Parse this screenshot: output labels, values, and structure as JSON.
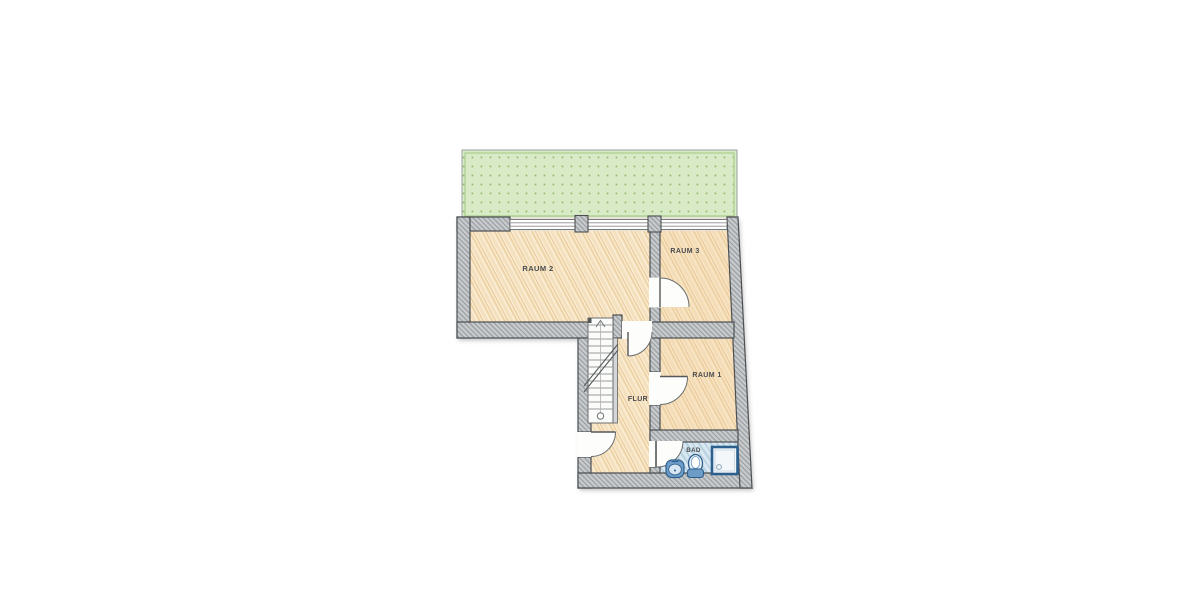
{
  "labels": {
    "room2": "RAUM 2",
    "room3": "RAUM 3",
    "room1": "RAUM 1",
    "hallway": "FLUR",
    "bathroom": "BAD"
  },
  "colors": {
    "background": "#ffffff",
    "terrace_fill": "#d8ebc6",
    "terrace_dot": "#8fba70",
    "terrace_edge": "#a9cd8d",
    "floor_fill": "#f9ecd2",
    "floor_stroke": "#e9c592",
    "warm_tint": "#f2cf9a",
    "wall_fill": "#c9ccce",
    "wall_hatch": "#999da0",
    "wall_outline": "#4d4f52",
    "bath_fill": "#d8e7f0",
    "bath_stroke": "#a9c8dd",
    "fixture_blue": "#6d9cc7",
    "fixture_light": "#e8f0f6",
    "fixture_outline": "#2d5f8e",
    "stair_fill": "#fbfbfa",
    "stair_step": "#9a9d9f",
    "door_line": "#6a6d6f",
    "label_color": "#4a4c4e",
    "opening_white": "#fdfdfc"
  }
}
